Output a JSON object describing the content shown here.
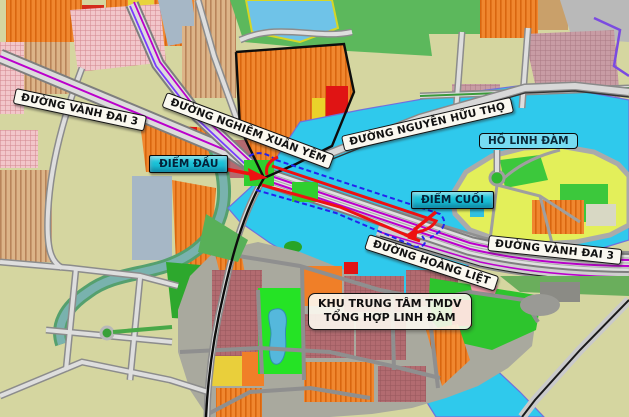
{
  "labels": {
    "vanh_dai_3_left": "ĐƯỜNG VÀNH ĐAI 3",
    "nghiem_xuan_yem": "ĐƯỜNG NGHIÊM XUÂN YÊM",
    "nguyen_huu_tho": "ĐƯỜNG NGUYỄN HỮU THỌ",
    "ho_linh_dam": "HỒ LINH ĐÀM",
    "diem_dau": "ĐIỂM ĐẦU",
    "diem_cuoi": "ĐIỂM CUỐI",
    "hoang_liet": "ĐƯỜNG HOÀNG LIỆT",
    "vanh_dai_3_right": "ĐƯỜNG VÀNH ĐAI 3",
    "khu_trung_tam_line1": "KHU TRUNG TÂM TMDV",
    "khu_trung_tam_line2": "TỔNG HỢP LINH ĐÀM"
  },
  "colors": {
    "lake": "#2fc9ec",
    "marker_fill": "#19c2d8",
    "lake_label_bg": "#76dcf2",
    "route_red": "#ee1111",
    "route_dash_blue": "#2323ee",
    "road_purple_line": "#bb00cc",
    "road_violet_line": "#7a3bff",
    "label_bg": "#faf8f0"
  }
}
